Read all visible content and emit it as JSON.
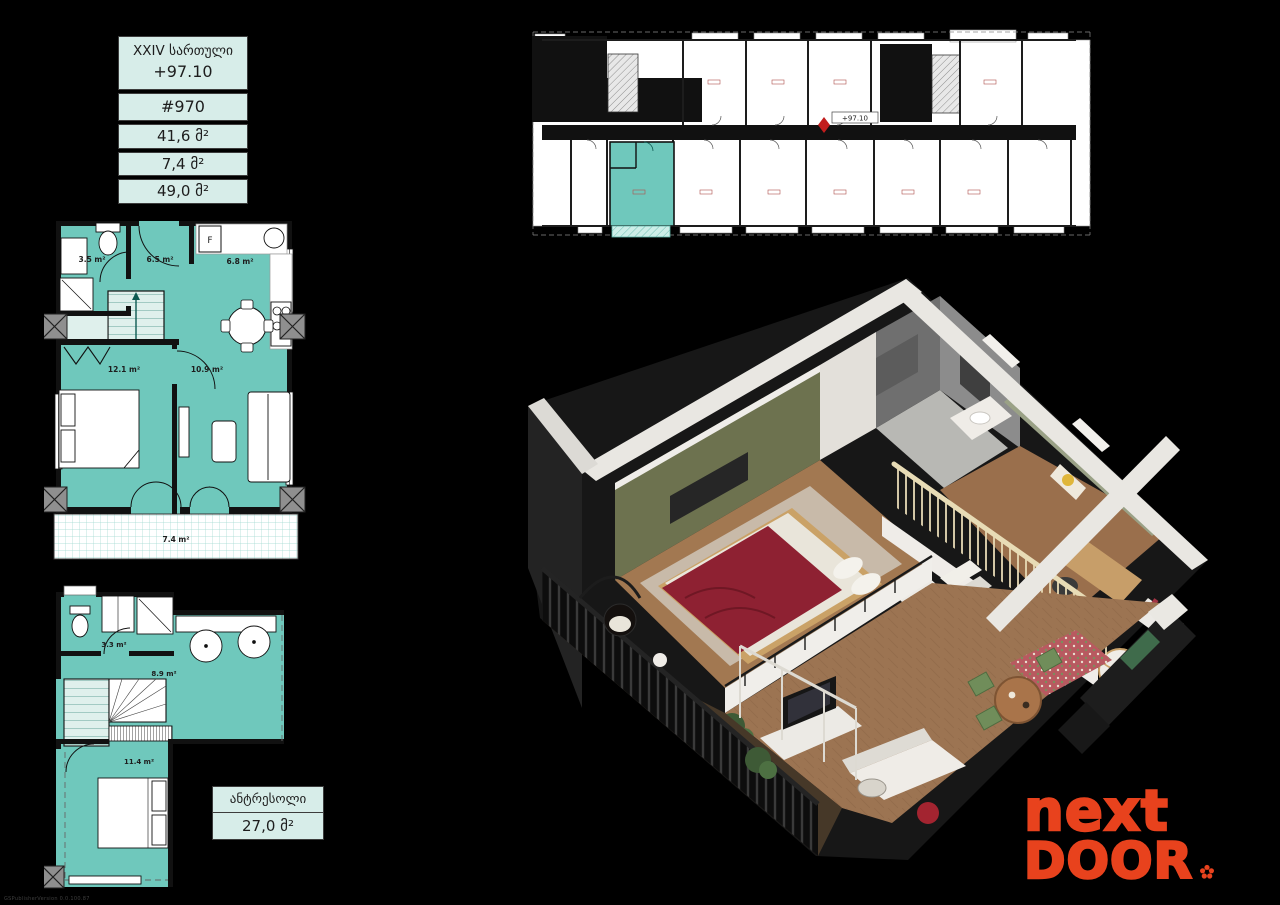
{
  "info_table": {
    "floor_label": "XXIV სართული",
    "elevation": "+97.10",
    "unit_number": "#970",
    "area_living": "41,6 მ²",
    "area_balcony": "7,4 მ²",
    "area_total": "49,0 მ²"
  },
  "building_plan": {
    "elevation_marker": "+97.10"
  },
  "main_plan": {
    "fridge_label": "F",
    "rooms": {
      "bathroom": "3.5 m²",
      "hall": "6.5 m²",
      "kitchen": "6.8 m²",
      "bedroom": "12.1 m²",
      "living": "10.9 m²",
      "balcony": "7.4 m²"
    }
  },
  "mezzanine_plan": {
    "rooms": {
      "bathroom": "3.3 m²",
      "hall": "8.9 m²",
      "bedroom": "11.4 m²"
    }
  },
  "mezzanine_table": {
    "label": "ანტრესოლი",
    "area": "27,0 მ²"
  },
  "logo": {
    "line1": "next",
    "line2": "DOOR"
  },
  "watermark": "GSPublisherVersion 0.0.100.87",
  "colors": {
    "unit_teal": "#6fc8bc",
    "table_bg": "#d7ede9",
    "logo_orange": "#e8421d"
  }
}
